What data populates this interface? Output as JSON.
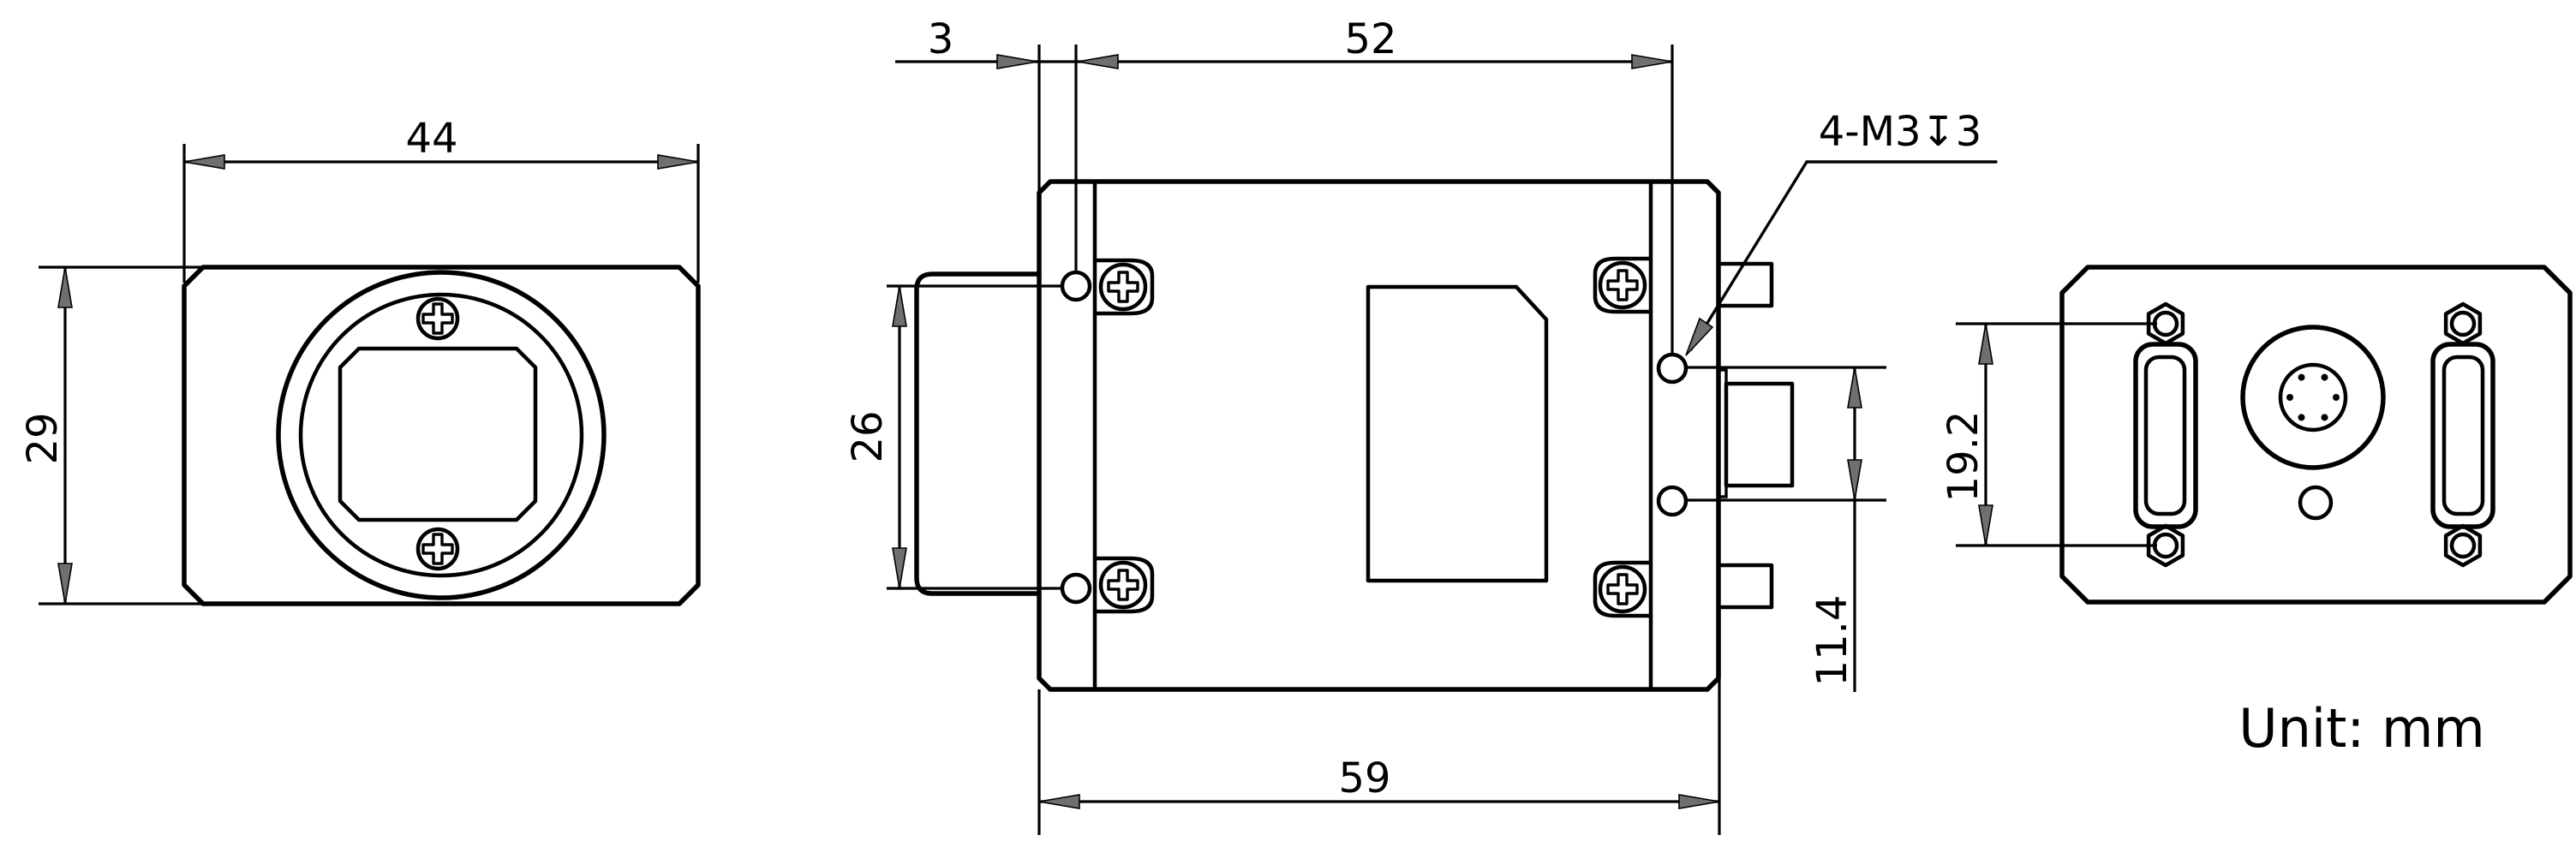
{
  "drawing_title": "industrial-camera-dimensional-drawing",
  "unit_note": "Unit: mm",
  "colors": {
    "line": "#000000",
    "arrow_fill": "#6f6f6f",
    "background": "#ffffff"
  },
  "front_view": {
    "width_dim": "44",
    "height_dim": "29"
  },
  "top_view": {
    "front_face_to_hole_dim": "3",
    "hole_span_dim": "52",
    "front_hole_spacing_dim": "26",
    "overall_depth_dim": "59",
    "rear_hole_spacing_dim": "11.4",
    "thread_callout": "4-M3↧3"
  },
  "rear_view": {
    "jackscrew_spacing_dim": "19.2"
  }
}
